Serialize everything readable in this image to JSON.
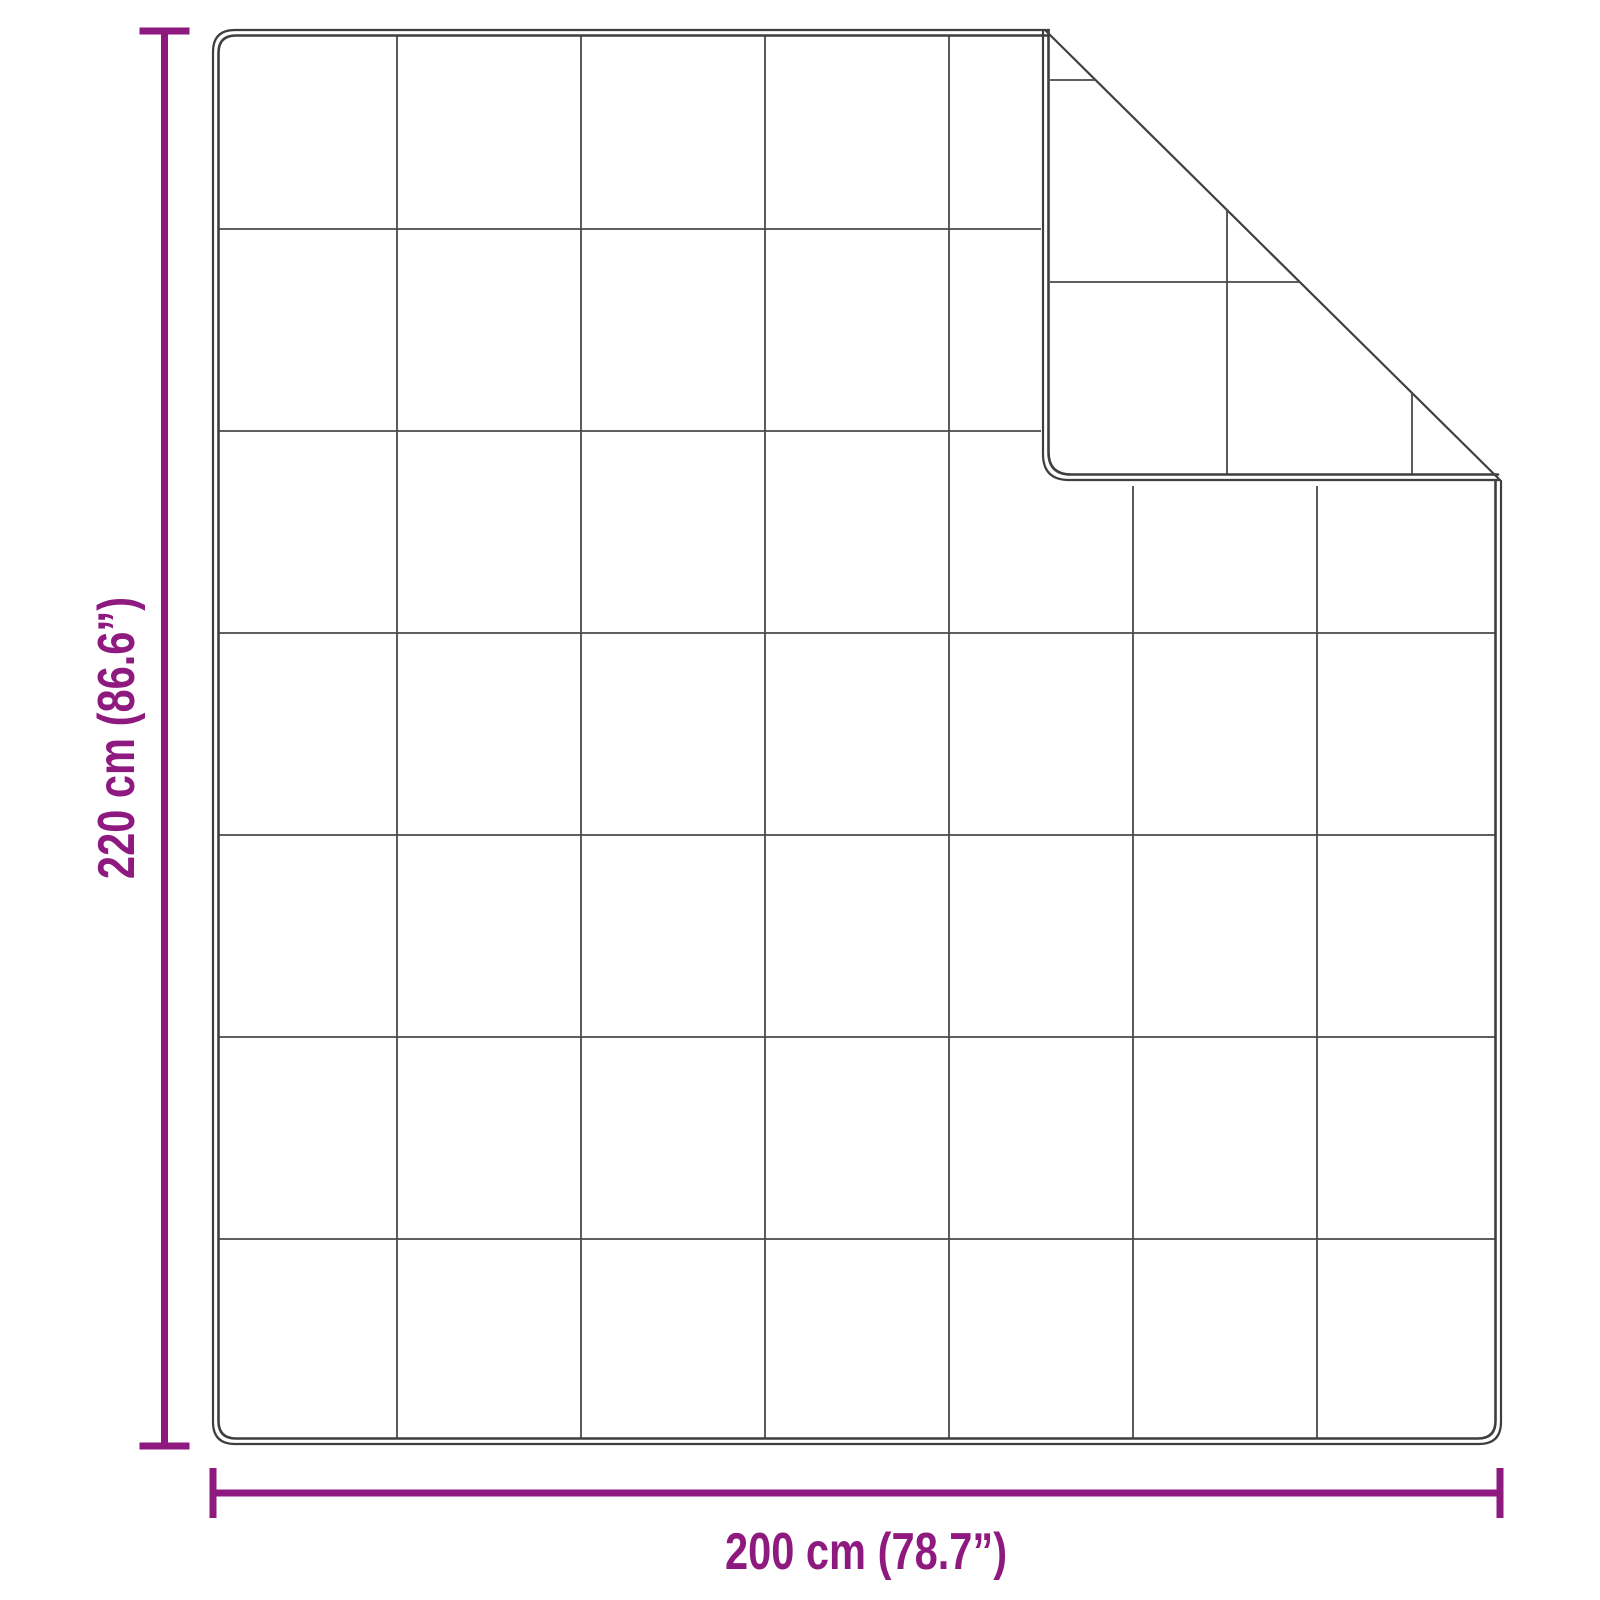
{
  "diagram": {
    "kind": "blanket-dimension-diagram",
    "height_label": "220 cm (86.6”)",
    "width_label": "200 cm (78.7”)",
    "quilt_grid": {
      "rows": 7,
      "columns": 7
    }
  },
  "colors": {
    "dimension_accent": "#8e1a80",
    "blanket_outline": "#3f3f3f",
    "quilt_grid_line": "#4a4a4a",
    "background": "#ffffff"
  }
}
